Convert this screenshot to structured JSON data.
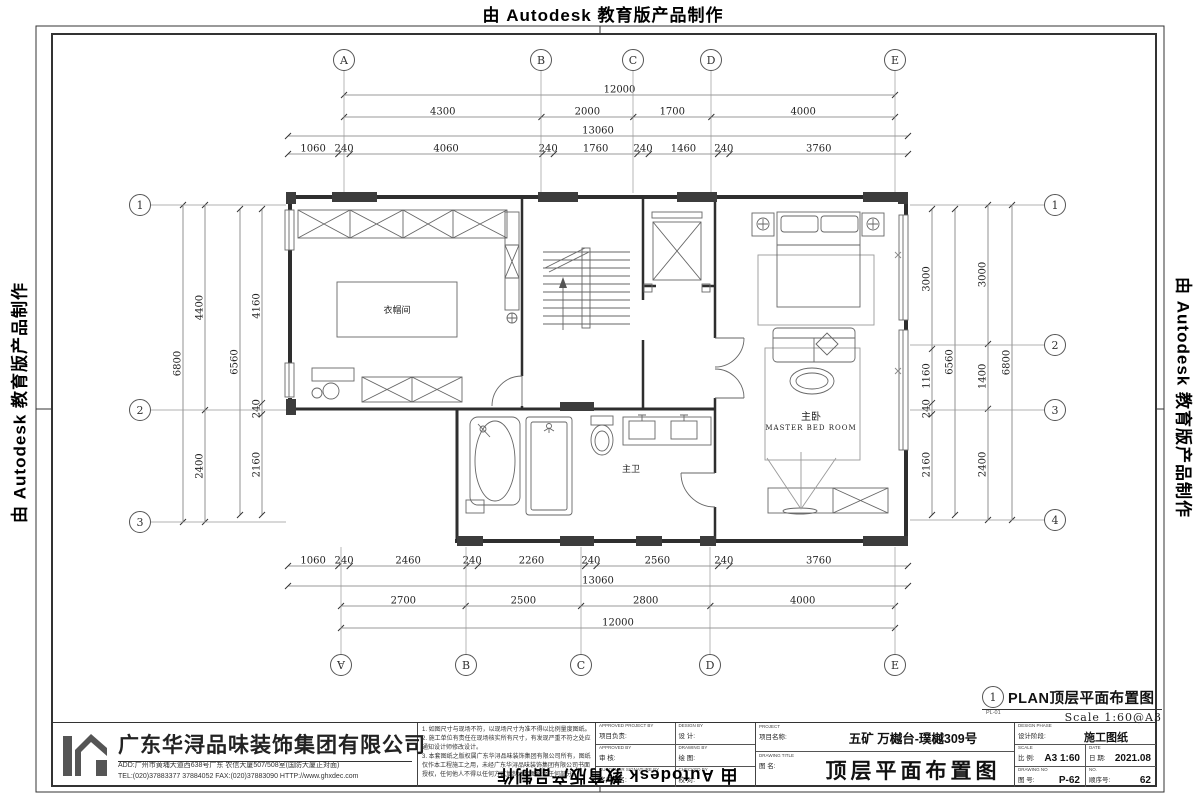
{
  "watermark": {
    "text": "由 Autodesk 教育版产品制作"
  },
  "grid": {
    "cols": [
      "A",
      "B",
      "C",
      "D",
      "E"
    ],
    "rows_left": [
      "1",
      "2",
      "3"
    ],
    "rows_right": [
      "1",
      "2",
      "3",
      "4"
    ]
  },
  "dims": {
    "top": {
      "overall": "12000",
      "axes": [
        "4300",
        "2000",
        "1700",
        "4000"
      ],
      "overall2": "13060",
      "detail": [
        "1060",
        "240",
        "4060",
        "240",
        "1760",
        "240",
        "1460",
        "240",
        "3760"
      ]
    },
    "bottom": {
      "detail": [
        "1060",
        "240",
        "2460",
        "240",
        "2260",
        "240",
        "2560",
        "240",
        "3760"
      ],
      "overall2": "13060",
      "axes": [
        "2700",
        "2500",
        "2800",
        "4000"
      ],
      "overall": "12000"
    },
    "left": {
      "overall": "6800",
      "axes": [
        "4400",
        "2400"
      ],
      "overall2": "6560",
      "detail": [
        "4160",
        "240",
        "2160"
      ]
    },
    "right": {
      "detail": [
        "3000",
        "1160",
        "240",
        "2160"
      ],
      "overall2": "6560",
      "axes": [
        "3000",
        "1400",
        "2400"
      ],
      "overall": "6800"
    }
  },
  "rooms": {
    "cloakroom": "衣帽间",
    "master_bath": "主卫",
    "master_bed_cn": "主卧",
    "master_bed_en": "MASTER BED ROOM"
  },
  "plan_label": {
    "num": "1",
    "code": "PL-01",
    "title": "PLAN顶层平面布置图",
    "scale": "Scale 1:60@A3"
  },
  "titleblock": {
    "company": "广东华浔品味装饰集团有限公司",
    "address": "ADD:广州市黄埔大道西638号广东 农信大厦507/508室(国防大厦正对面)",
    "contact": "TEL:(020)37883377  37884052    FAX:(020)37883090    HTTP://www.ghxdec.com",
    "notes": [
      "1. 如图尺寸与现场不符，以现场尺寸为准不得以比例量度图纸。",
      "2. 施工单位有责任在现场核实所有尺寸，有发现严重不符之处应通知设计师修改设计。",
      "3. 本套图纸之版权属广东华浔品味装饰集团有限公司所有，图纸仅作本工程施工之用，未经广东华浔品味装饰集团有限公司书面授权，任何他人不得以任何方式复制本套图纸之任何部分。"
    ],
    "sign_cells": [
      {
        "en": "APPROVED PROJECT BY",
        "cn": "项目负责:"
      },
      {
        "en": "DESIGN BY",
        "cn": "设 计:"
      },
      {
        "en": "APPROVED BY",
        "cn": "审 核:"
      },
      {
        "en": "DRAWING BY",
        "cn": "绘 图:"
      },
      {
        "en": "CUSTOMER SIGNATURE BY",
        "cn": "客户签名:"
      },
      {
        "en": "CHECKED BY",
        "cn": "校 对:"
      }
    ],
    "project_en": "PROJECT",
    "project_cn": "项目名称:",
    "project_value": "五矿 万樾台-璞樾309号",
    "drawing_en": "DRAWING TITLE",
    "drawing_cn": "图 名:",
    "drawing_value": "顶层平面布置图",
    "phase_en": "DESIGN PHASE",
    "phase_cn": "设计阶段:",
    "phase_value": "施工图纸",
    "scale_en": "SCALE",
    "scale_cn": "比 例:",
    "scale_value": "A3 1:60",
    "date_en": "DATE",
    "date_cn": "日 期:",
    "date_value": "2021.08",
    "dwgno_en": "DRAWING No",
    "dwgno_cn": "图 号:",
    "dwgno_value": "P-62",
    "no_en": "NO.",
    "no_cn": "顺序号:",
    "no_value": "62"
  }
}
